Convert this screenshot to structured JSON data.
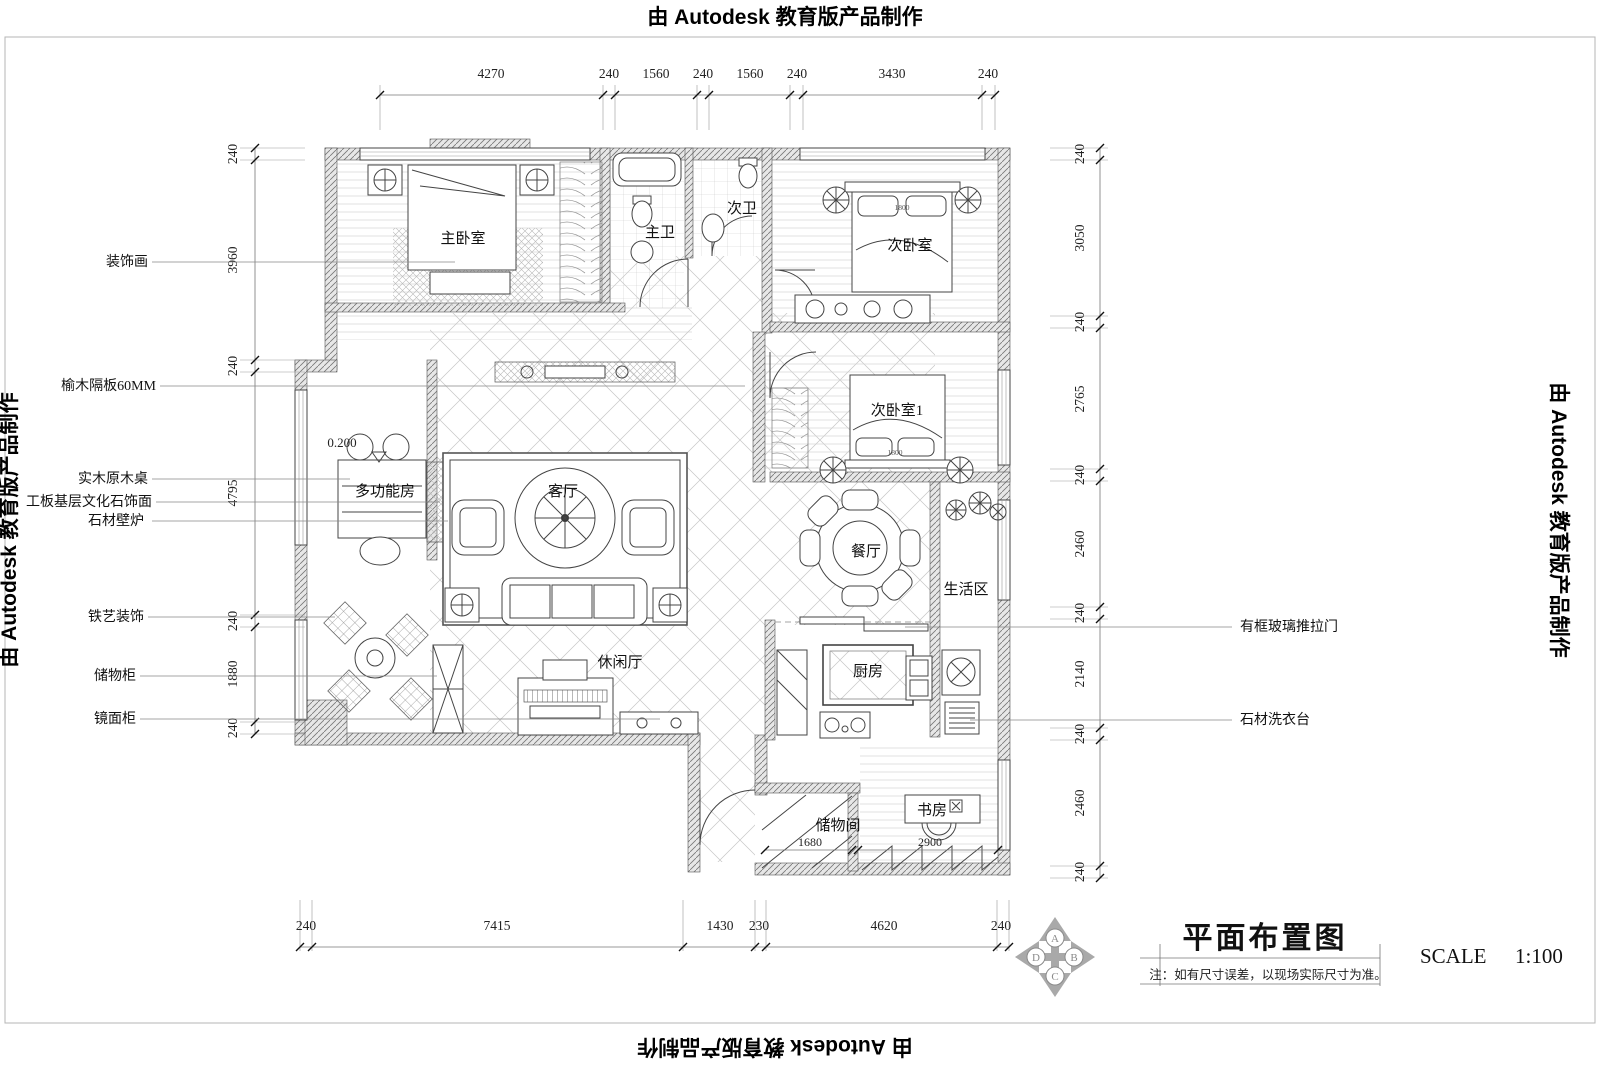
{
  "watermark": "由 Autodesk 教育版产品制作",
  "rooms": {
    "master_bedroom": "主卧室",
    "master_bath": "主卫",
    "second_bath": "次卫",
    "second_bedroom": "次卧室",
    "second_bedroom1": "次卧室1",
    "living_room": "客厅",
    "multi_room": "多功能房",
    "dining_room": "餐厅",
    "living_area": "生活区",
    "kitchen": "厨房",
    "leisure_hall": "休闲厅",
    "study": "书房",
    "storage_room": "储物间"
  },
  "annotations": {
    "left": [
      "装饰画",
      "榆木隔板60MM",
      "实木原木桌",
      "工板基层文化石饰面",
      "石材壁炉",
      "铁艺装饰",
      "储物柜",
      "镜面柜"
    ],
    "right": [
      "有框玻璃推拉门",
      "石材洗衣台"
    ]
  },
  "dims": {
    "top": [
      "4270",
      "240",
      "1560",
      "240",
      "1560",
      "240",
      "3430",
      "240"
    ],
    "left": [
      "240",
      "3960",
      "240",
      "4795",
      "240",
      "1880",
      "240"
    ],
    "right": [
      "240",
      "3050",
      "240",
      "2765",
      "240",
      "2460",
      "240",
      "2140",
      "240",
      "2460",
      "240"
    ],
    "bottom": [
      "240",
      "7415",
      "1430",
      "230",
      "4620",
      "240"
    ]
  },
  "inner_dims": {
    "storage_width": "1680",
    "study_width": "2900",
    "level": "0.200",
    "bed_width_1": "1800",
    "bed_width_2": "1800"
  },
  "title_block": {
    "title": "平面布置图",
    "note": "注：如有尺寸误差，以现场实际尺寸为准。",
    "scale_label": "SCALE",
    "scale_value": "1:100",
    "compass": {
      "top": "A",
      "right": "B",
      "bottom": "C",
      "left": "D"
    }
  }
}
